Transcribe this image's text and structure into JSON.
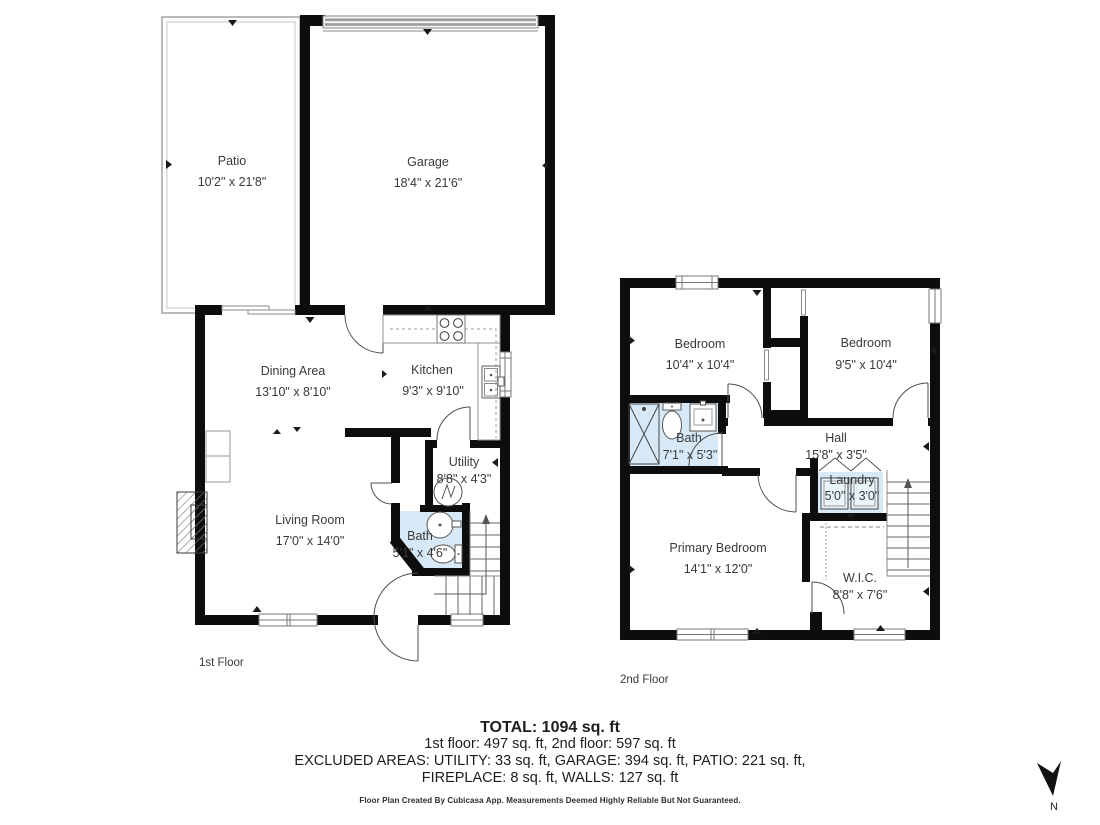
{
  "floor1": {
    "label": "1st Floor",
    "rooms": {
      "patio": {
        "name": "Patio",
        "dims": "10'2\" x 21'8\""
      },
      "garage": {
        "name": "Garage",
        "dims": "18'4\" x 21'6\""
      },
      "dining": {
        "name": "Dining Area",
        "dims": "13'10\" x 8'10\""
      },
      "kitchen": {
        "name": "Kitchen",
        "dims": "9'3\" x 9'10\""
      },
      "utility": {
        "name": "Utility",
        "dims": "8'8\" x 4'3\""
      },
      "living": {
        "name": "Living Room",
        "dims": "17'0\" x 14'0\""
      },
      "bath": {
        "name": "Bath",
        "dims": "5'1\" x 4'6\""
      }
    }
  },
  "floor2": {
    "label": "2nd Floor",
    "rooms": {
      "bedroom1": {
        "name": "Bedroom",
        "dims": "10'4\" x 10'4\""
      },
      "bedroom2": {
        "name": "Bedroom",
        "dims": "9'5\" x 10'4\""
      },
      "bath": {
        "name": "Bath",
        "dims": "7'1\" x 5'3\""
      },
      "hall": {
        "name": "Hall",
        "dims": "15'8\" x 3'5\""
      },
      "laundry": {
        "name": "Laundry",
        "dims": "5'0\" x 3'0\""
      },
      "primary": {
        "name": "Primary Bedroom",
        "dims": "14'1\" x 12'0\""
      },
      "wic": {
        "name": "W.I.C.",
        "dims": "8'8\" x 7'6\""
      }
    }
  },
  "summary": {
    "total": "TOTAL: 1094 sq. ft",
    "floors_line": "1st floor: 497 sq. ft, 2nd floor: 597 sq. ft",
    "excluded_line": "EXCLUDED AREAS: UTILITY: 33 sq. ft, GARAGE: 394 sq. ft, PATIO: 221 sq. ft,",
    "fireplace_walls_line": "FIREPLACE: 8 sq. ft, WALLS: 127 sq. ft",
    "disclaimer": "Floor Plan Created By Cubicasa App. Measurements Deemed Highly Reliable But Not Guaranteed."
  },
  "compass": {
    "label": "N"
  },
  "colors": {
    "wall": "#0d0d0d",
    "wet_room": "#d7e9f7",
    "garage_door": "#9c9c9c",
    "text": "#3a3a3a"
  }
}
